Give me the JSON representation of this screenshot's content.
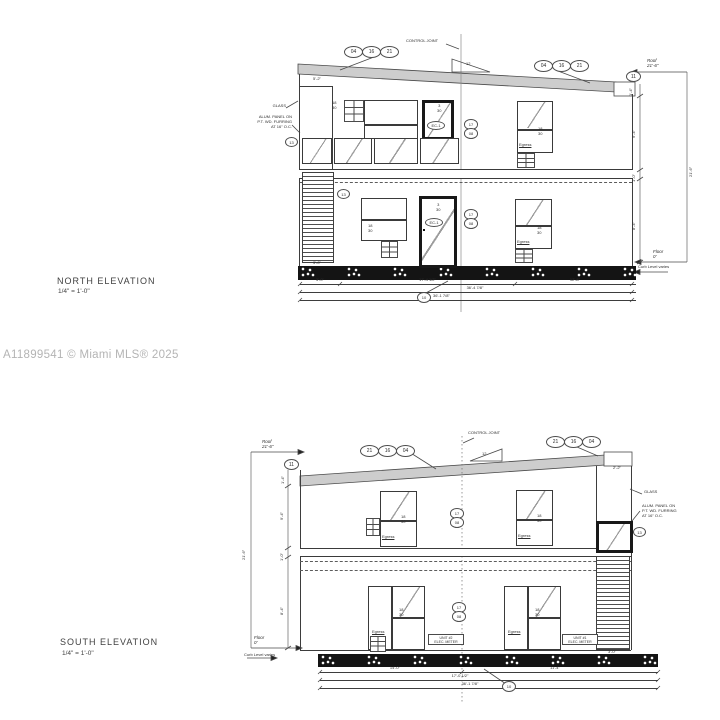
{
  "watermark": "A11899541 © Miami MLS® 2025",
  "shared": {
    "tag18": "18",
    "tag30": "30",
    "tag3": "3",
    "ec1": "EC-1",
    "egress": "Egress",
    "b17": "17",
    "b08": "08",
    "b13": "13",
    "b11": "11",
    "b10": "10",
    "slope": "12"
  },
  "levels": {
    "roof_label": "Roof",
    "roof_value": "21'-6\"",
    "floor_label": "Floor",
    "floor_value": "0'",
    "curb_note": "Curb Level varies"
  },
  "north": {
    "title": "NORTH ELEVATION",
    "scale": "1/4\" = 1'-0\"",
    "roof_tag": [
      "04",
      "16",
      "21"
    ],
    "joint_note": "CONTROL JOINT",
    "glass_note": "GLASS",
    "panel_note_l1": "ALUM. PANEL ON",
    "panel_note_l2": "P.T. WD. FURRING",
    "panel_note_l3": "AT 16\" O.C.",
    "dims": {
      "bay": "5'-2\"",
      "parapet": "1'-4\"",
      "upper": "9'-4\"",
      "band": "1'-0\"",
      "lower": "8'-4\"",
      "total": "21'-6\"",
      "louver": "3'-0\"",
      "bot1": "3'-0\"",
      "bot2": "17'-4 1/2\"",
      "bot3": "12'-8\"",
      "bot_sub": "36'-4 7/8\"",
      "bot_total": "36'-1 7/8\""
    }
  },
  "south": {
    "title": "SOUTH ELEVATION",
    "scale": "1/4\" = 1'-0\"",
    "roof_tag": [
      "21",
      "16",
      "04"
    ],
    "joint_note": "CONTROL JOINT",
    "glass_note": "GLASS",
    "panel_note_l1": "ALUM. PANEL ON",
    "panel_note_l2": "P.T. WD. FURRING",
    "panel_note_l3": "AT 16\" O.C.",
    "unit2_box_l1": "UNIT #2",
    "unit2_box_l2": "ELEC. METER",
    "unit1_box_l1": "UNIT #1",
    "unit1_box_l2": "ELEC. METER",
    "dims": {
      "cap": "2'-2\"",
      "parapet": "1'-4\"",
      "upper": "9'-4\"",
      "band": "1'-0\"",
      "lower": "8'-4\"",
      "total": "21'-6\"",
      "louver": "3'-0\"",
      "bot1": "14'-0\"",
      "bot1b": "11'-4\"",
      "bot2": "17'-0 1/2\"",
      "bot_total": "36'-1 7/8\""
    }
  }
}
